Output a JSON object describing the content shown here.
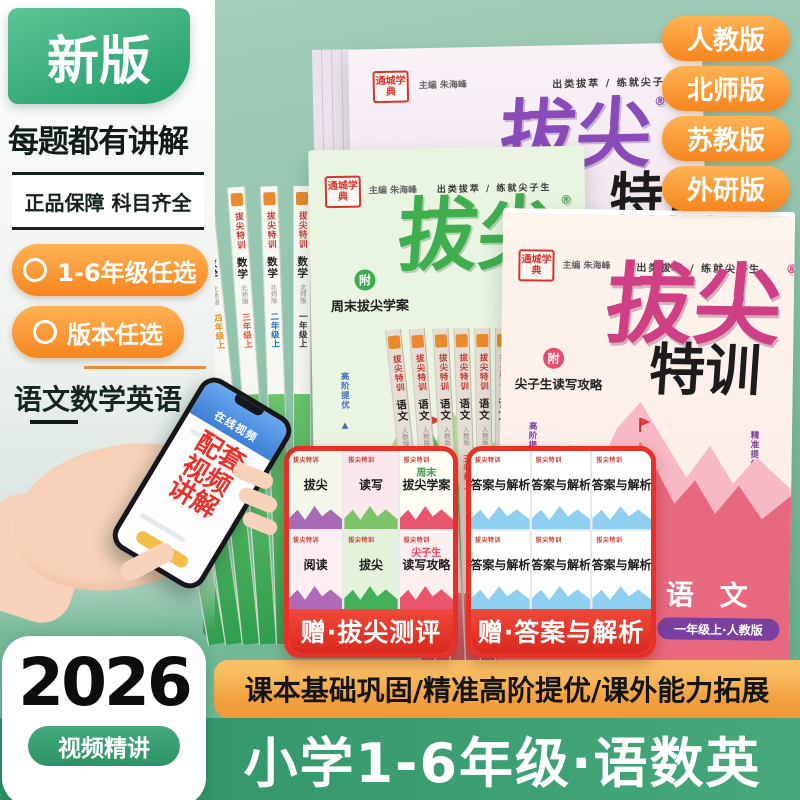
{
  "colors": {
    "brand_green": "#2f9267",
    "accent_orange": "#f6861f",
    "badge_red": "#e73127",
    "title_pink": "#cf3f85",
    "title_purple": "#8a4bb8",
    "title_green": "#3fae4f",
    "grade_pill_purple": "#7b3fa0",
    "bg_green": "#8fc3ab"
  },
  "top": {
    "new_badge": "新版",
    "version_pills": [
      "人教版",
      "北师版",
      "苏教版",
      "外研版"
    ]
  },
  "left": {
    "headline": "每题都有讲解",
    "guarantee": "正品保障 科目齐全",
    "feature_pills": [
      "1-6年级任选",
      "版本任选"
    ],
    "subjects_line": "语文数学英语",
    "phone": {
      "screen_header": "在线视频",
      "overlay_lines": [
        "配套",
        "视频",
        "讲解"
      ]
    },
    "year_box": {
      "year": "2026",
      "tag": "视频精讲"
    }
  },
  "covers": {
    "brand": "通城学典",
    "editor": "主编 朱海峰",
    "slogan": "出类拔萃 / 练就尖子生",
    "title_main": "拔尖",
    "title_sub": "特训",
    "reg": "®",
    "green_book": {
      "badge": "附",
      "gift": "周末拔尖学案",
      "side_note": "高阶提优 ▲"
    },
    "pink_book": {
      "badge": "附",
      "gift": "尖子生读写攻略",
      "side_left": "高阶提优 ▲",
      "side_right": "精准提优 ▲",
      "subject": "语 文",
      "grade_pill": "一年级上·人教版"
    }
  },
  "spines": {
    "green": {
      "series": "拔尖特训",
      "subject": "数学",
      "version": "北师版",
      "grades": [
        "六年级上",
        "五年级上",
        "四年级上",
        "三年级上",
        "二年级上",
        "一年级上"
      ]
    },
    "tan": {
      "series": "拔尖特训",
      "subject": "语文",
      "version": "人教版",
      "grades": [
        "六年级上",
        "五年级上",
        "四年级上",
        "三年级上",
        "二年级上",
        "一年级上"
      ]
    }
  },
  "gifts": {
    "left": {
      "band": "赠·拔尖测评",
      "logo": "拔尖特训",
      "covers": [
        {
          "accent": "",
          "title": "拔尖"
        },
        {
          "accent": "",
          "title": "读写"
        },
        {
          "accent": "周末",
          "title": "拔尖学案"
        },
        {
          "accent": "",
          "title": "阅读"
        },
        {
          "accent": "",
          "title": "拔尖"
        },
        {
          "accent": "尖子生",
          "title": "读写攻略"
        }
      ]
    },
    "right": {
      "band": "赠·答案与解析",
      "logo": "拔尖特训",
      "title": "答案与解析"
    }
  },
  "bottom": {
    "features": "课本基础巩固/精准高阶提优/课外能力拓展",
    "headline": "小学1-6年级·语数英"
  }
}
